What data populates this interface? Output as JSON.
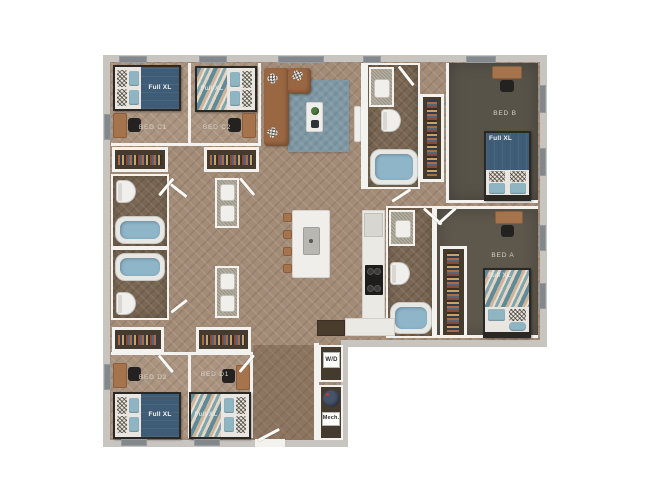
{
  "image_type": "apartment-unit-floor-plan",
  "floorplan": {
    "bedrooms": [
      {
        "label": "BED C1",
        "bed_label": "Full XL"
      },
      {
        "label": "BED C2",
        "bed_label": "Full XL"
      },
      {
        "label": "BED B",
        "bed_label": "Full XL"
      },
      {
        "label": "BED A",
        "bed_label": "Full XL"
      },
      {
        "label": "BED D2",
        "bed_label": "Full XL"
      },
      {
        "label": "BED D1",
        "bed_label": "Full XL"
      }
    ],
    "utility": {
      "washer_dryer": "W/D",
      "mechanical": "Mech."
    },
    "colors": {
      "background": "#ffffff",
      "outer_wall": "#c8c5c0",
      "interior_wall": "#f3f2ef",
      "wood_floor": "#a28b77",
      "bedroom_floor": "#aa9480",
      "bath_floor": "#796753",
      "carpet": "#5a554b",
      "rug": "#7e98a4",
      "sofa": "#9a6743",
      "bed_blanket_navy": "#3f5c77",
      "tub_water": "#8fb5c9",
      "label_text": "#d8d3c9"
    }
  }
}
